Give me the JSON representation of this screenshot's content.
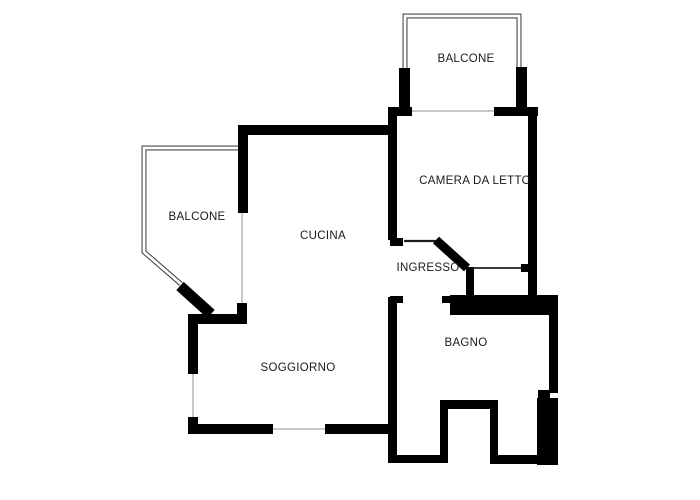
{
  "plan": {
    "title": "apartment-floor-plan",
    "type": "floor-plan",
    "colors": {
      "background": "#ffffff",
      "wall": "#000000",
      "railing": "#4a4a4a",
      "sill": "#b5b5b5",
      "label_text": "#1a1a1a"
    },
    "rooms": {
      "balcone_top": "BALCONE",
      "camera_da_letto": "CAMERA DA LETTO",
      "balcone_left": "BALCONE",
      "cucina": "CUCINA",
      "ingresso": "INGRESSO",
      "soggiorno": "SOGGIORNO",
      "bagno": "BAGNO"
    }
  }
}
